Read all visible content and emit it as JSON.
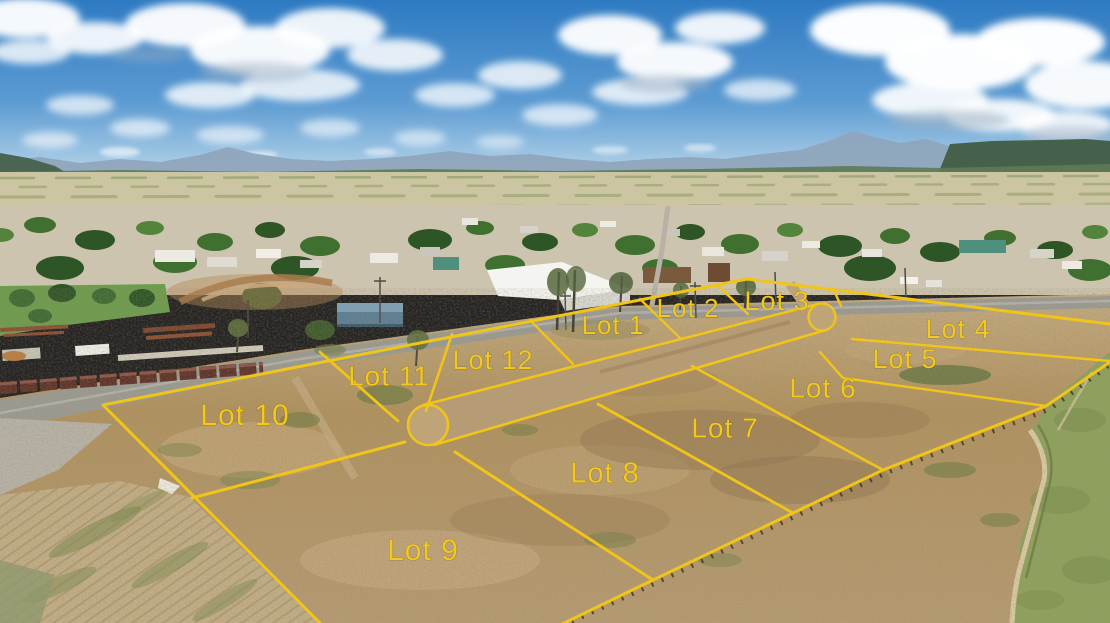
{
  "image": {
    "kind": "aerial-drone-photo",
    "description": "Aerial view of a 12-lot land subdivision outlined in yellow beside a small town, with plains, mountains and a cloudy blue sky on the horizon",
    "width_px": 1110,
    "height_px": 623
  },
  "overlay": {
    "boundary_color": "#f0c419",
    "label_color": "#f2c91c",
    "road_feature": "central street with cul-de-sac bulbs at both ends"
  },
  "lots": [
    {
      "label": "Lot 1"
    },
    {
      "label": "Lot 2"
    },
    {
      "label": "Lot 3"
    },
    {
      "label": "Lot 4"
    },
    {
      "label": "Lot 5"
    },
    {
      "label": "Lot 6"
    },
    {
      "label": "Lot 7"
    },
    {
      "label": "Lot 8"
    },
    {
      "label": "Lot 9"
    },
    {
      "label": "Lot 10"
    },
    {
      "label": "Lot 11"
    },
    {
      "label": "Lot 12"
    }
  ]
}
